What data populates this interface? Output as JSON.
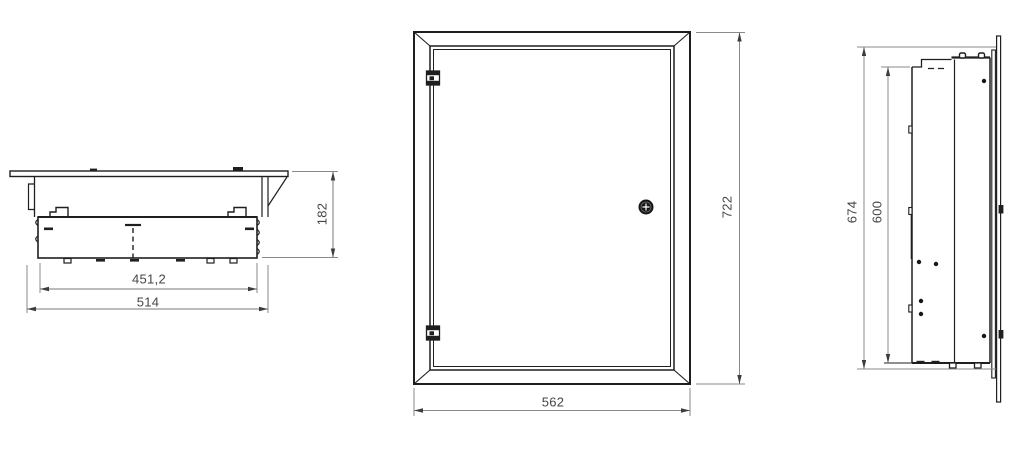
{
  "views": {
    "top_view": {
      "dimensions": {
        "inner_width": "451,2",
        "body_width": "514",
        "depth": "182"
      }
    },
    "front_view": {
      "dimensions": {
        "frame_width": "562",
        "frame_height": "722"
      }
    },
    "side_view": {
      "dimensions": {
        "body_height": "674",
        "mounting_plate_height": "600"
      }
    }
  },
  "colors": {
    "background": "#ffffff",
    "line": "#1f1f1f",
    "dimension_line": "#8a8a8a",
    "dimension_text": "#46444a"
  }
}
